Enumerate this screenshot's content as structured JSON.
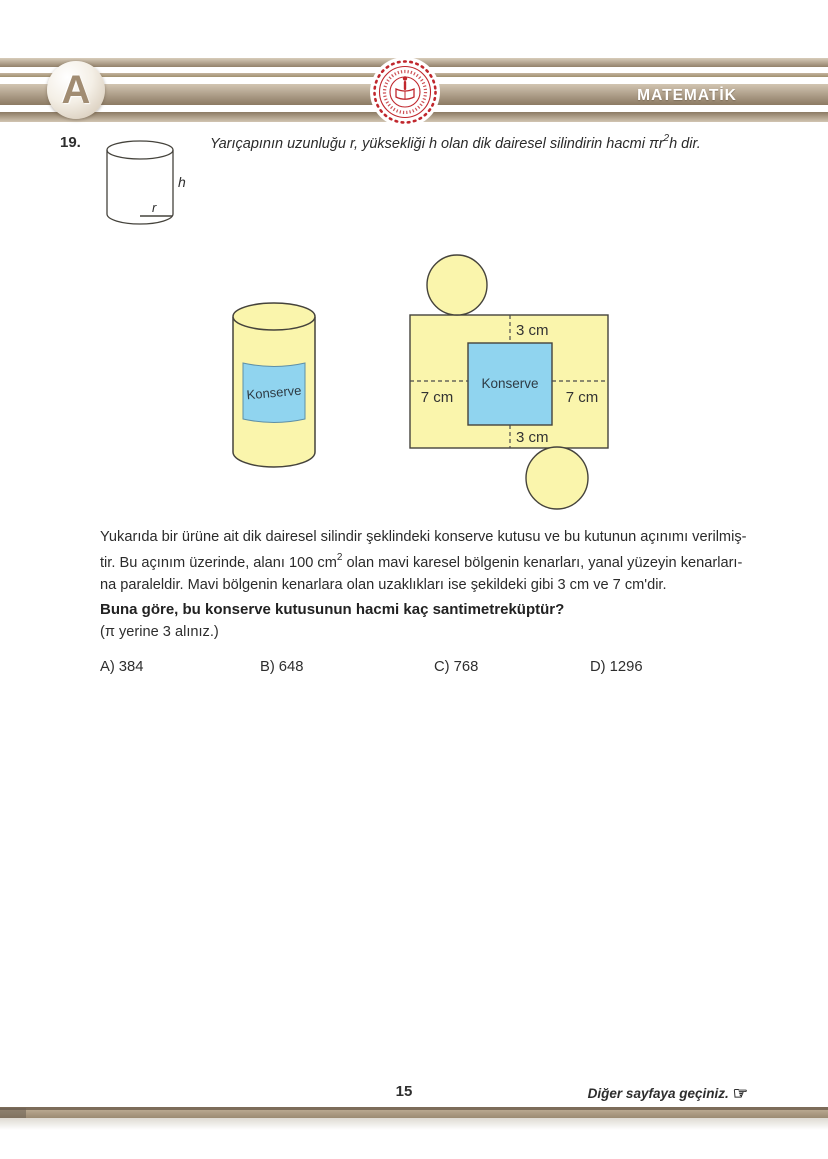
{
  "colors": {
    "accent_tan": "#a5927a",
    "emblem_red": "#c0272d",
    "figure_yellow": "#faf5ac",
    "figure_blue": "#90d4ef"
  },
  "header": {
    "booklet_letter": "A",
    "subject": "MATEMATİK"
  },
  "question": {
    "number": "19.",
    "intro_pre": "Yarıçapının uzunluğu r, yüksekliği h olan dik dairesel silindirin hacmi πr",
    "intro_sup": "2",
    "intro_post": "h dir.",
    "cyl_height_label": "h",
    "cyl_radius_label": "r"
  },
  "figure": {
    "can_label": "Konserve",
    "net_label": "Konserve",
    "dim_top": "3 cm",
    "dim_bottom": "3 cm",
    "dim_left": "7 cm",
    "dim_right": "7 cm"
  },
  "paragraph": {
    "line1": "Yukarıda bir ürüne ait dik dairesel silindir şeklindeki konserve kutusu ve bu kutunun açınımı verilmiş-",
    "line2_pre": "tir. Bu açınım üzerinde, alanı 100 cm",
    "line2_sup": "2",
    "line2_post": " olan mavi karesel bölgenin kenarları, yanal yüzeyin kenarları-",
    "line3": "na paraleldir. Mavi bölgenin kenarlara olan uzaklıkları ise şekildeki gibi 3 cm ve 7 cm'dir."
  },
  "prompt": {
    "bold": "Buna göre, bu konserve kutusunun hacmi kaç santimetreküptür?",
    "note": "(π yerine 3 alınız.)"
  },
  "options": [
    {
      "letter": "A)",
      "value": "384"
    },
    {
      "letter": "B)",
      "value": "648"
    },
    {
      "letter": "C)",
      "value": "768"
    },
    {
      "letter": "D)",
      "value": "1296"
    }
  ],
  "footer": {
    "page_number": "15",
    "next_page": "Diğer sayfaya geçiniz.",
    "hand_icon": "☞"
  }
}
